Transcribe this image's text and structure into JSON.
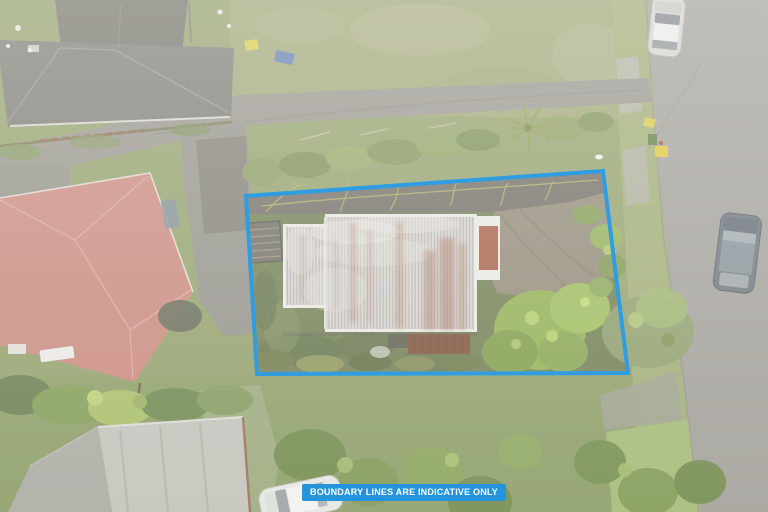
{
  "banner": {
    "text": "BOUNDARY LINES ARE INDICATIVE ONLY",
    "background": "#2494dc",
    "text_color": "#ffffff"
  },
  "boundary": {
    "points": "246,196 603,171 628,373 257,374",
    "color": "#2f9de2",
    "stroke_width": "4"
  },
  "scene": {
    "setting": "hazy aerial drone photo of a suburban property for sale, boundary outlined in blue",
    "objects": [
      "main-house-corrugated-metal-roof",
      "rusted-roof-panel",
      "rear-deck",
      "pergola",
      "asphalt-driveway",
      "garden-conifers",
      "neighbour-house-dark-roof-top-left",
      "neighbour-house-red-roof-left",
      "neighbour-building-bottom-left",
      "street-road-right",
      "grass-berm-and-footpath",
      "power-pole-with-bins",
      "parked-silver-car-top-right",
      "parked-suv-on-road",
      "parked-white-car-bottom",
      "lawns-trees-hedges"
    ],
    "palette": {
      "boundary_blue": "#2f9de2",
      "banner_blue": "#2494dc",
      "grass_olive": "#8f9e67",
      "road_grey": "#a09d97",
      "asphalt_dark": "#6b685f",
      "metal_roof_grey": "#c8c4c1",
      "rust_brown": "#a55a40",
      "red_roof": "#c98579",
      "dark_roof": "#6e6c64",
      "bright_tree_green": "#9cbb58"
    }
  }
}
